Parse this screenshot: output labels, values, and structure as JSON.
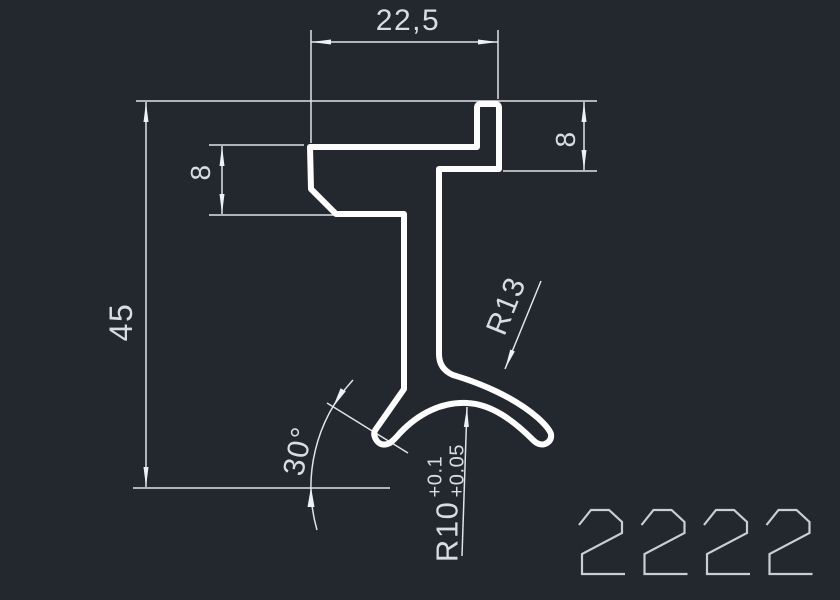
{
  "window": {
    "background_color": "#23272e"
  },
  "colors": {
    "profile_outline": "#fdfdfd",
    "dimension_lines": "#dfe3e7",
    "dimension_text": "#d9dde1",
    "drawing_number": "#c9ced3"
  },
  "drawing": {
    "number": "2222"
  },
  "dimensions": {
    "top_width": "22,5",
    "overall_height": "45",
    "left_flange_thickness": "8",
    "right_hook_height": "8",
    "outer_radius": "R13",
    "inner_radius": "R10",
    "inner_radius_tolerance_upper": "+0.1",
    "inner_radius_tolerance_lower": "+0.05",
    "foot_angle": "30°"
  }
}
